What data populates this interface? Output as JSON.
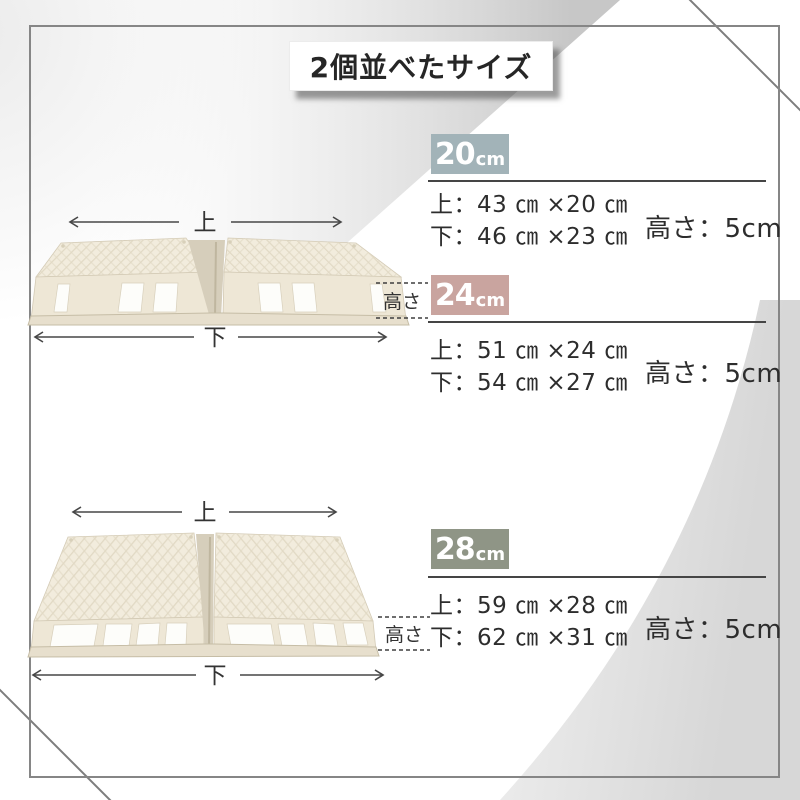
{
  "page": {
    "title": "2個並べたサイズ"
  },
  "sections": [
    {
      "badge": {
        "number": "20",
        "unit": "cm",
        "color": "#a2b3b8",
        "style": "background:#a2b3b8"
      },
      "dims": {
        "top": "上：43 ㎝ ×20 ㎝",
        "bottom": "下：46 ㎝ ×23 ㎝"
      },
      "height": "高さ：5cm"
    },
    {
      "badge": {
        "number": "24",
        "unit": "cm",
        "color": "#c9a49f",
        "style": "background:#c9a49f"
      },
      "dims": {
        "top": "上：51 ㎝ ×24 ㎝",
        "bottom": "下：54 ㎝ ×27 ㎝"
      },
      "height": "高さ：5cm"
    },
    {
      "badge": {
        "number": "28",
        "unit": "cm",
        "color": "#8f9586",
        "style": "background:#8f9586"
      },
      "dims": {
        "top": "上：59 ㎝ ×28 ㎝",
        "bottom": "下：62 ㎝ ×31 ㎝"
      },
      "height": "高さ：5cm"
    }
  ],
  "diagrams": [
    {
      "top": "上",
      "bottom": "下",
      "height": "高さ"
    },
    {
      "top": "上",
      "bottom": "下",
      "height": "高さ"
    }
  ]
}
